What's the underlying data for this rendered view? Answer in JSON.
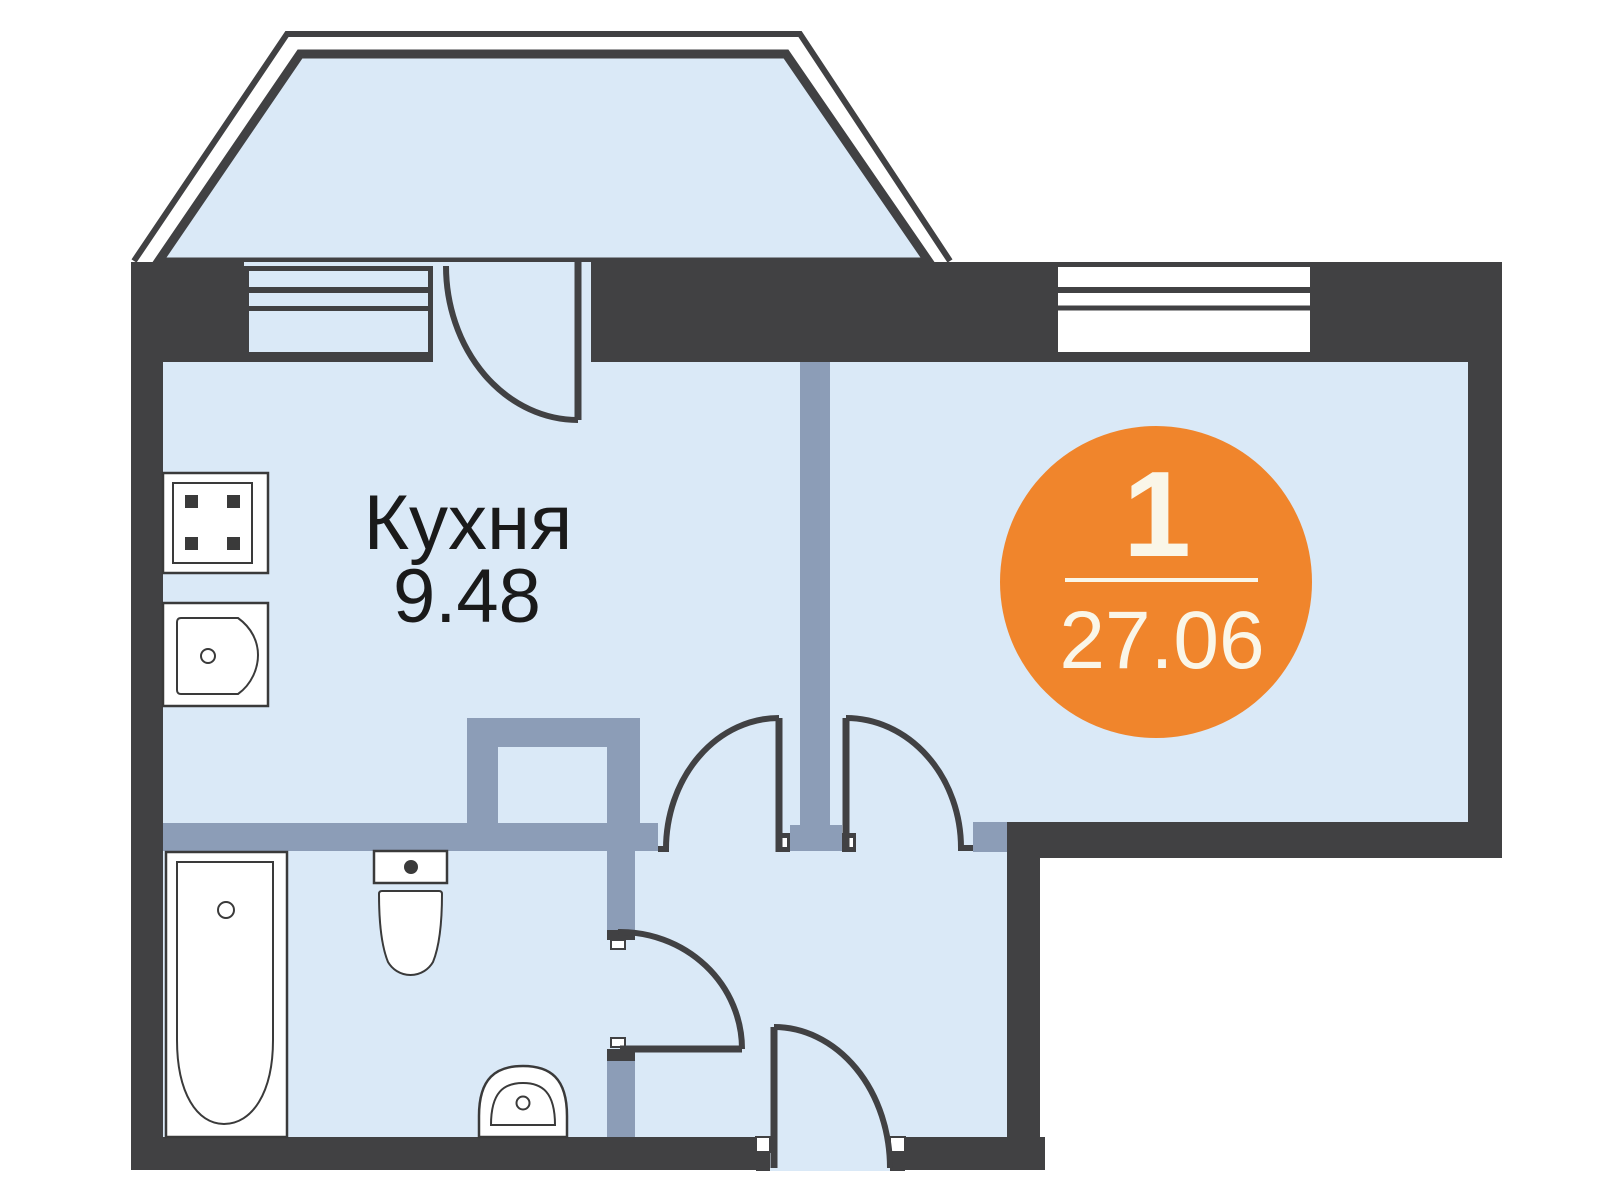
{
  "floorplan": {
    "room_label": "Кухня",
    "room_area": "9.48",
    "badge": {
      "room_count": "1",
      "total_area": "27.06"
    },
    "fixtures": [
      "stove",
      "kitchen-sink",
      "bathtub",
      "toilet",
      "bathroom-sink"
    ],
    "features": [
      "bay-window",
      "kitchen-window",
      "balcony-door",
      "living-room-window",
      "kitchen-door",
      "living-room-door",
      "bathroom-door",
      "entrance-door"
    ]
  },
  "colors": {
    "bg": "#FFFFFF",
    "wall": "#414143",
    "room": "#DAE9F7",
    "partition": "#8C9DB7",
    "accent": "#F0852C",
    "badge-text": "#FAF6E8",
    "fixture-stroke": "#3A3A3A",
    "label": "#1A1A1A"
  }
}
